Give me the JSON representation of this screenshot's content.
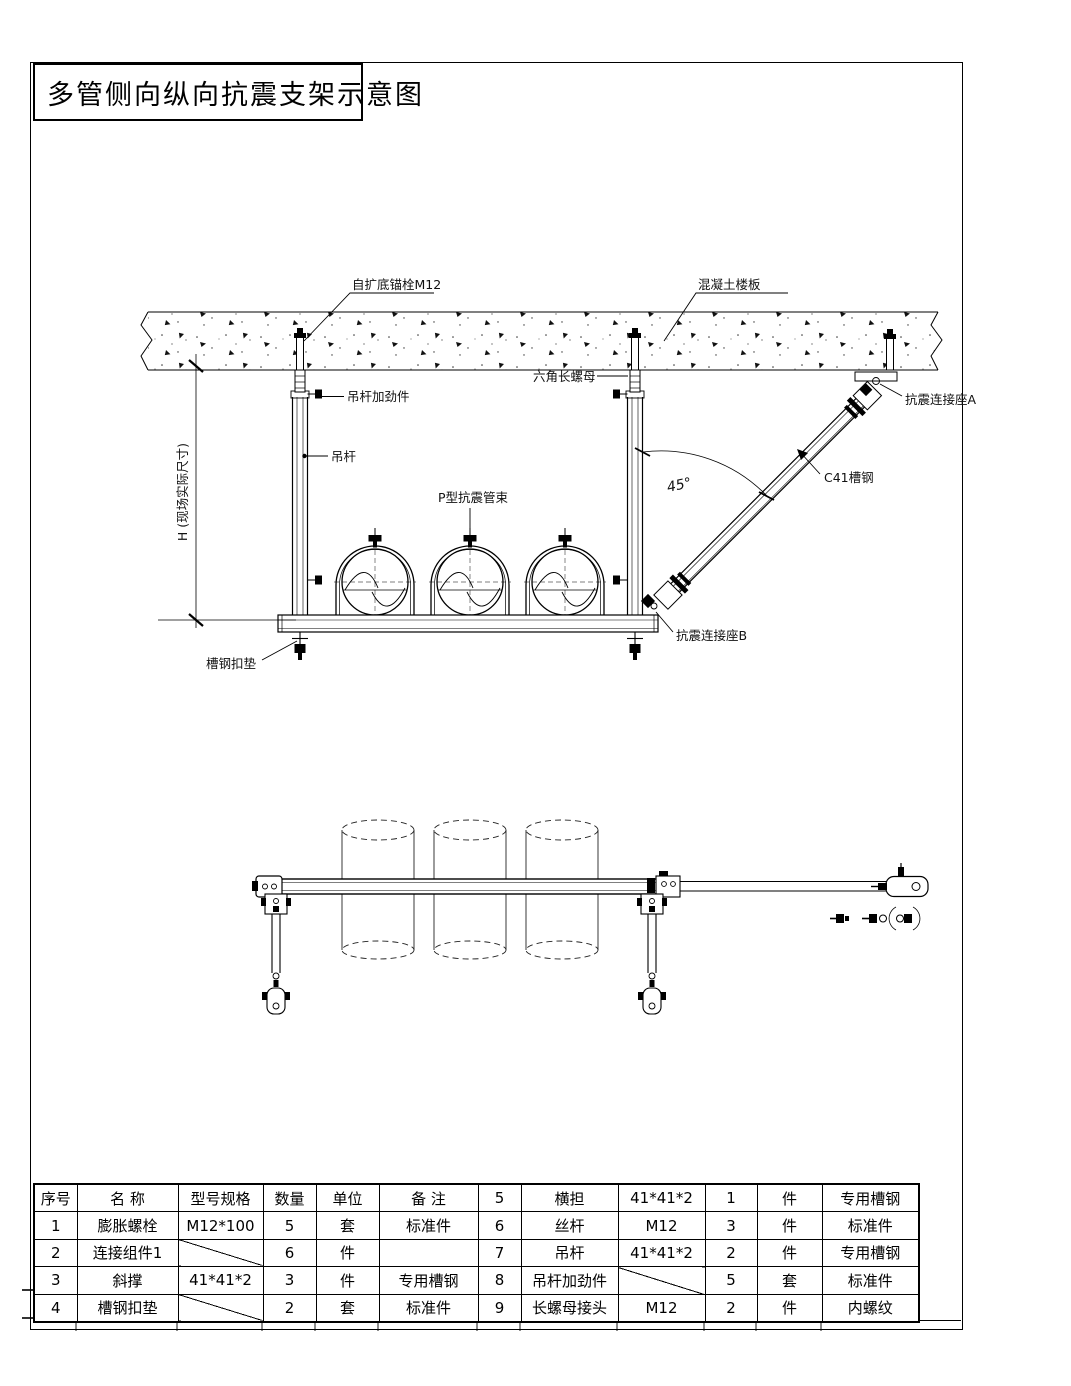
{
  "page": {
    "title": "多管侧向纵向抗震支架示意图"
  },
  "colors": {
    "line": "#000000",
    "background": "#ffffff"
  },
  "elevation": {
    "labels": {
      "anchor_bolt": "自扩底锚栓M12",
      "concrete_slab": "混凝土楼板",
      "hex_long_nut": "六角长螺母",
      "hanger_stiffener": "吊杆加劲件",
      "hanger_rod": "吊杆",
      "p_clamp": "P型抗震管束",
      "seismic_seat_a": "抗震连接座A",
      "channel_c41": "C41槽钢",
      "angle": "45°",
      "seismic_seat_b": "抗震连接座B",
      "channel_pad": "槽钢扣垫",
      "height_dim": "H (现场实际尺寸)"
    }
  },
  "table": {
    "header": [
      "序号",
      "名 称",
      "型号规格",
      "数量",
      "单位",
      "备 注"
    ],
    "left_rows": [
      [
        "1",
        "膨胀螺栓",
        "M12*100",
        "5",
        "套",
        "标准件"
      ],
      [
        "2",
        "连接组件1",
        "",
        "6",
        "件",
        ""
      ],
      [
        "3",
        "斜撑",
        "41*41*2",
        "3",
        "件",
        "专用槽钢"
      ],
      [
        "4",
        "槽钢扣垫",
        "",
        "2",
        "套",
        "标准件"
      ]
    ],
    "right_rows": [
      [
        "5",
        "横担",
        "41*41*2",
        "1",
        "件",
        "专用槽钢"
      ],
      [
        "6",
        "丝杆",
        "M12",
        "3",
        "件",
        "标准件"
      ],
      [
        "7",
        "吊杆",
        "41*41*2",
        "2",
        "件",
        "专用槽钢"
      ],
      [
        "8",
        "吊杆加劲件",
        "",
        "5",
        "套",
        "标准件"
      ],
      [
        "9",
        "长螺母接头",
        "M12",
        "2",
        "件",
        "内螺纹"
      ]
    ]
  }
}
